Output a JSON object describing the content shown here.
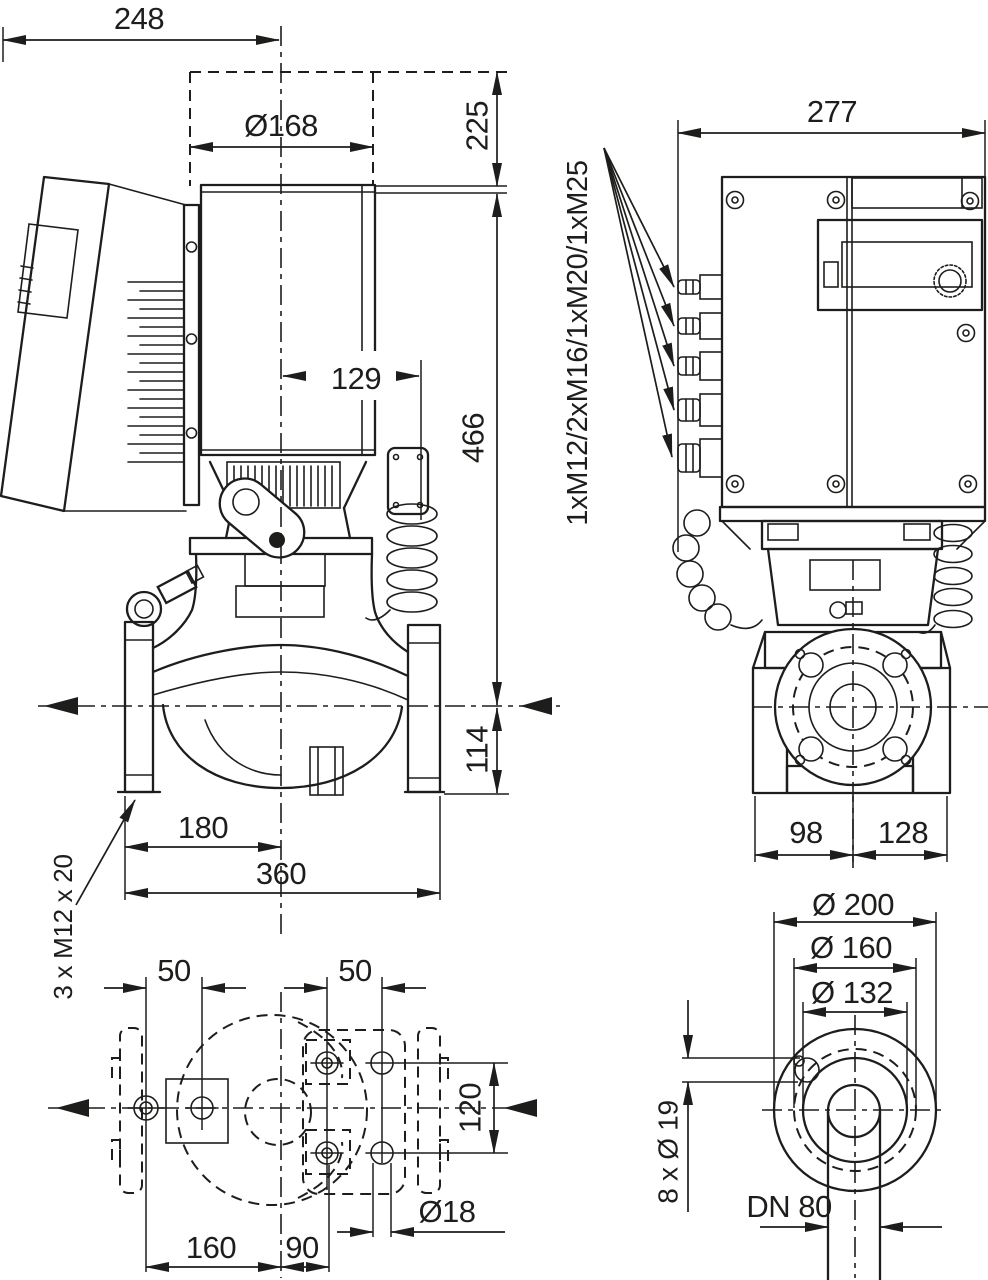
{
  "meta": {
    "drawing_type": "inline pump dimensional drawing",
    "ink_color": "#1d1d1b",
    "background_color": "#ffffff"
  },
  "side_view": {
    "dim_top_width": "248",
    "dim_motor_diameter": "Ø168",
    "dim_head_height": "225",
    "dim_axis_offset": "129",
    "dim_body_height": "466",
    "dim_base_height": "114",
    "dim_foot_spacing": "180",
    "dim_foot_width": "360",
    "note_anchor_bolts": "3 x M12 x 20"
  },
  "front_view": {
    "dim_total_width": "277",
    "note_cable_glands": "1xM12/2xM16/1xM20/1xM25",
    "dim_axis_to_left": "98",
    "dim_axis_to_right": "128"
  },
  "plan_view": {
    "dim_hole_pitch_left": "50",
    "dim_hole_pitch_right": "50",
    "dim_hole_pitch_vertical": "120",
    "dim_hole_diameter": "Ø18",
    "dim_axis_to_left_holes": "160",
    "dim_axis_to_right_holes": "90"
  },
  "flange_view": {
    "dim_outer_diameter": "Ø 200",
    "dim_bolt_circle": "Ø 160",
    "dim_raised_face": "Ø 132",
    "note_bolt_holes": "8 x Ø 19",
    "label_nominal_bore": "DN 80"
  }
}
